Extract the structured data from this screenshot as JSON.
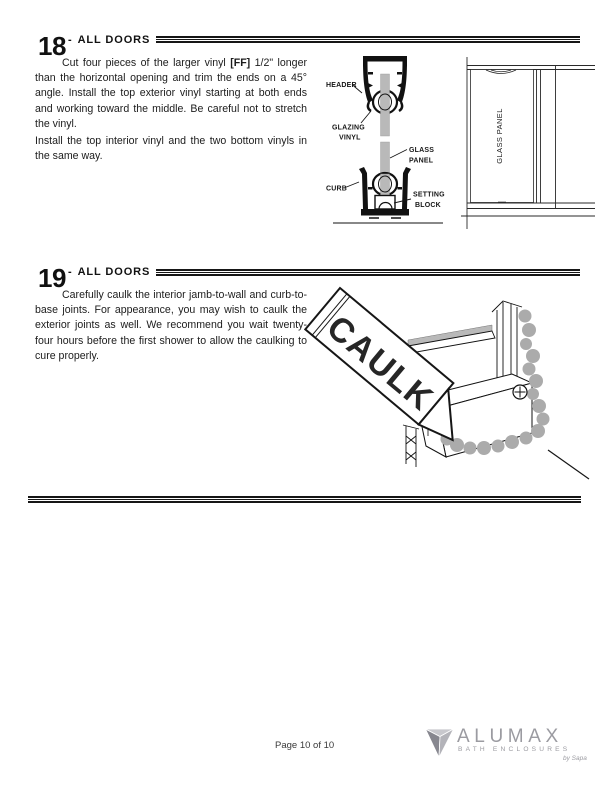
{
  "step18": {
    "number": "18",
    "dash": "-",
    "title": "ALL DOORS",
    "para1_pre": "Cut four pieces of the larger vinyl ",
    "para1_bold": "[FF]",
    "para1_post": " 1/2\" longer than the horizontal opening and trim the ends on a 45° angle.  Install the top exterior vinyl starting at both ends and working toward the middle.  Be careful not to stretch the vinyl.",
    "para2": "Install the top interior vinyl and the two bottom vinyls in the same way.",
    "labels": {
      "header": "HEADER",
      "glazing1": "GLAZING",
      "glazing2": "VINYL",
      "glass1": "GLASS",
      "glass2": "PANEL",
      "curb": "CURB",
      "setting1": "SETTING",
      "setting2": "BLOCK",
      "elevation_glass": "GLASS PANEL"
    }
  },
  "step19": {
    "number": "19",
    "dash": "-",
    "title": "ALL DOORS",
    "para": "Carefully caulk the interior jamb-to-wall and curb-to-base joints.  For appearance, you may wish to caulk the exterior joints as well.  We recommend you wait twenty-four hours before the first shower to allow the caulking to cure properly.",
    "labels": {
      "caulk": "CAULK"
    }
  },
  "footer": {
    "page_label": "Page 10 of 10",
    "brand_name": "ALUMAX",
    "brand_tagline": "BATH ENCLOSURES",
    "brand_byline": "by Sapa"
  },
  "colors": {
    "text": "#1c1c1c",
    "rule": "#161616",
    "glass_gray": "#b9b9b9",
    "caulk_bead_gray": "#ababab",
    "logo_gray": "#9b9ba1"
  }
}
